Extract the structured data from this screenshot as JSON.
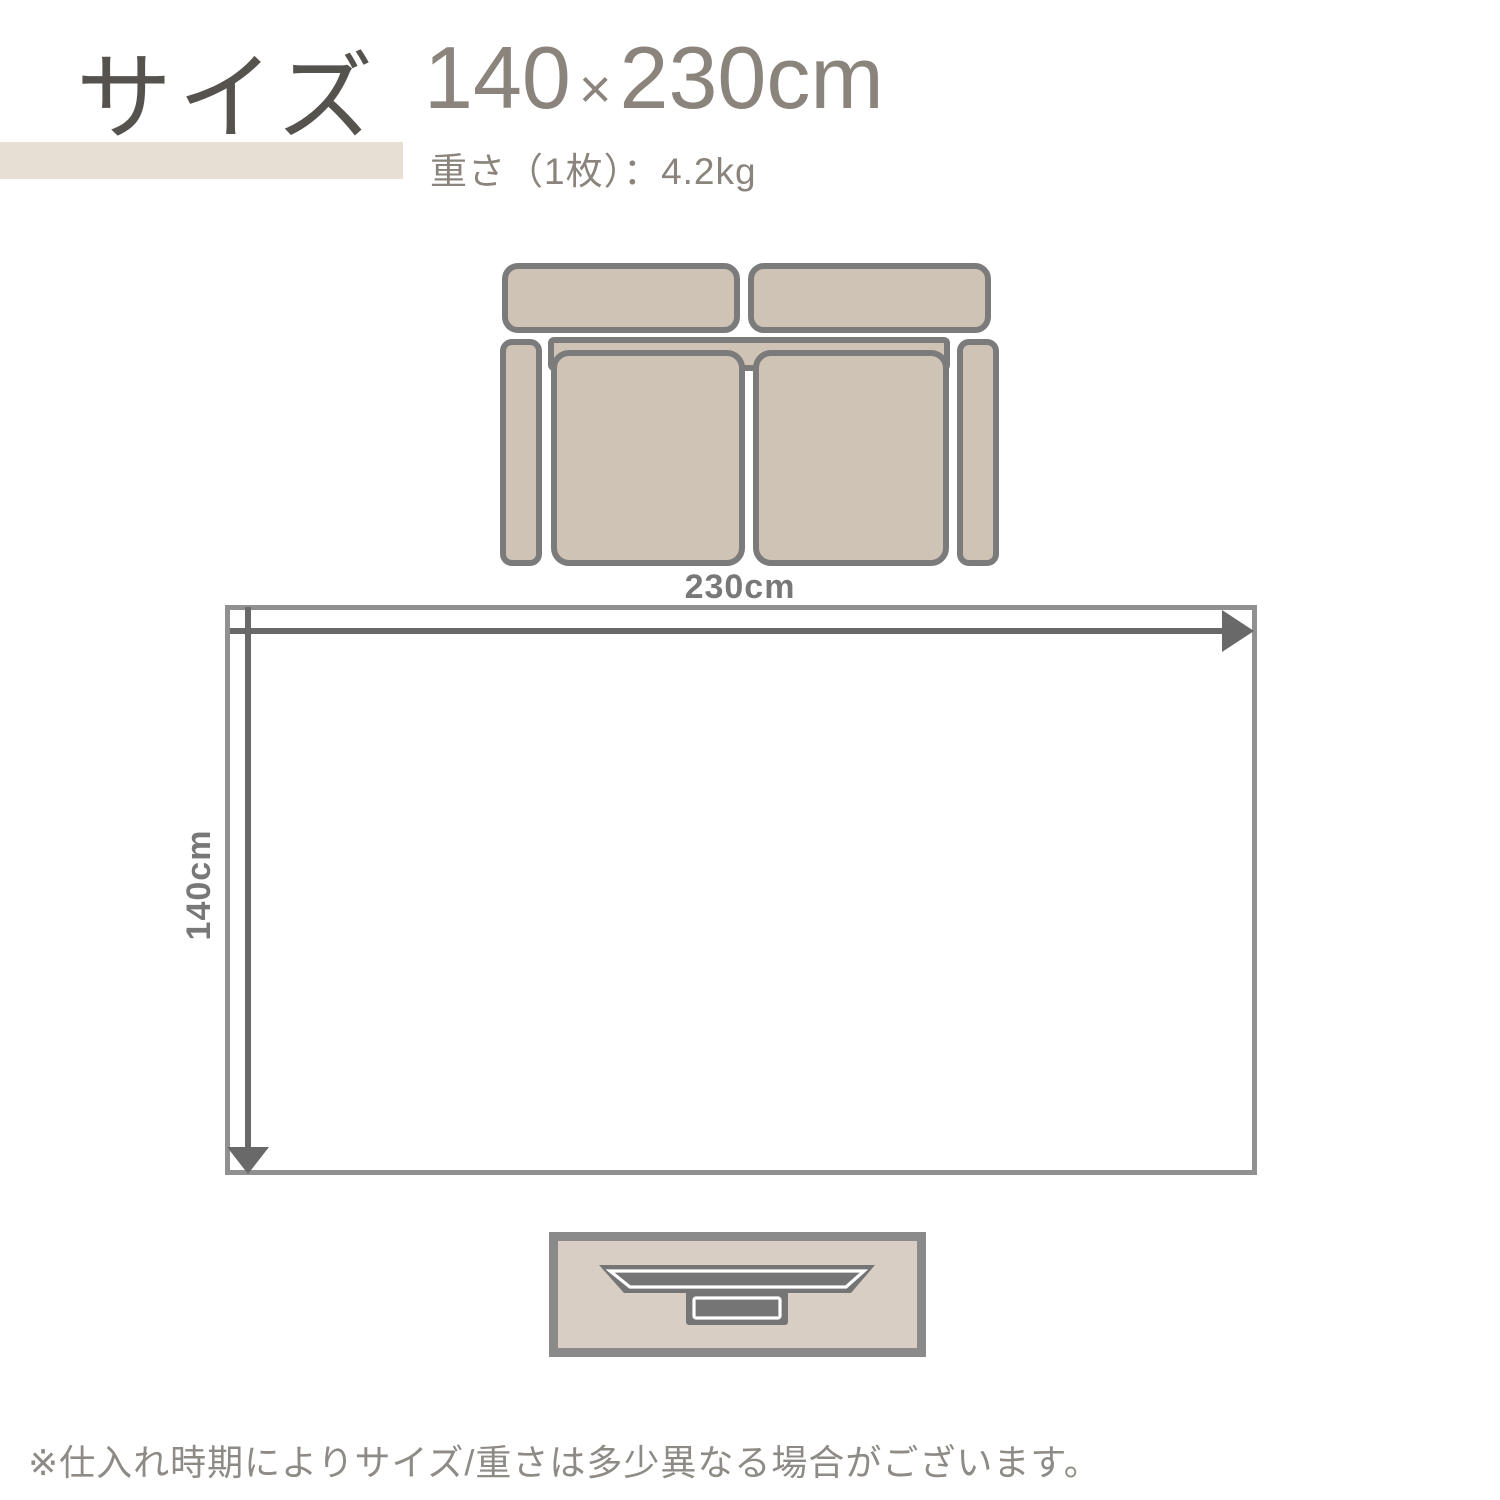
{
  "header": {
    "title": "サイズ",
    "size_width": "140",
    "size_times": "×",
    "size_height": "230cm",
    "weight_text": "重さ（1枚）：4.2kg"
  },
  "diagram": {
    "width_label": "230cm",
    "height_label": "140cm"
  },
  "footnote": {
    "text": "※仕入れ時期によりサイズ/重さは多少異なる場合がございます。"
  },
  "colors": {
    "page-bg": "#ffffff",
    "title-color": "#56524e",
    "header-text": "#8b847c",
    "accent-bar": "#e7dfd4",
    "sofa-fill": "#cfc3b5",
    "sofa-outline": "#7b7b7b",
    "rug-border": "#909090",
    "arrow": "#696969",
    "dim-label": "#787878",
    "board-fill": "#d8cec3",
    "board-outline": "#8a8a8a",
    "tv-dark": "#757575",
    "tv-highlight": "#ffffff",
    "note-color": "#8e8a85"
  }
}
